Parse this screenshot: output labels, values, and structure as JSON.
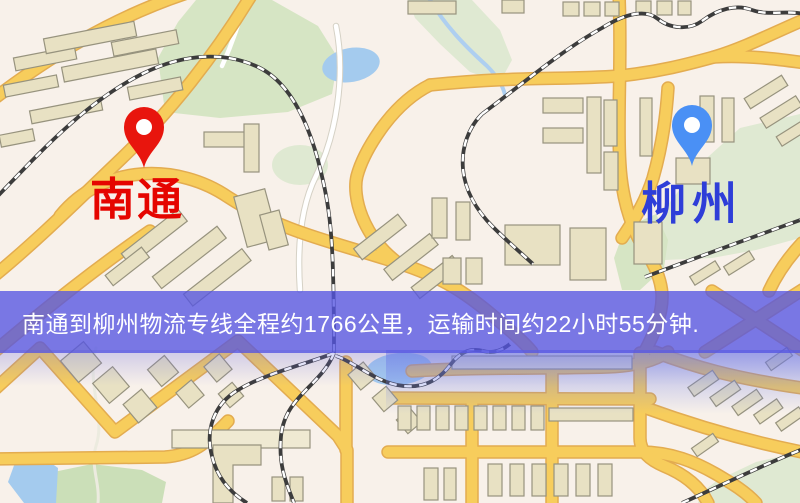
{
  "banner": {
    "text": "南通到柳州物流专线全程约1766公里，运输时间约22小时55分钟.",
    "background": "rgba(85,85,226,0.78)",
    "text_color": "#ffffff",
    "distance_text": "约1766公里",
    "duration_text": "约22小时55分钟"
  },
  "origin": {
    "name": "南通",
    "label_color": "#e50500",
    "pin_color": "#e8150d"
  },
  "destination": {
    "name": "柳州",
    "label_color": "#2e3ed8",
    "pin_color": "#4a90f5"
  },
  "map_palette": {
    "background": "#f8f1ea",
    "road": "#f7cd5c",
    "road_casing": "#e3ac50",
    "building": "#e8e1c3",
    "park_green": "#d6e5c4",
    "water_blue": "#a4cbee",
    "railway": "#3c3c3c"
  }
}
